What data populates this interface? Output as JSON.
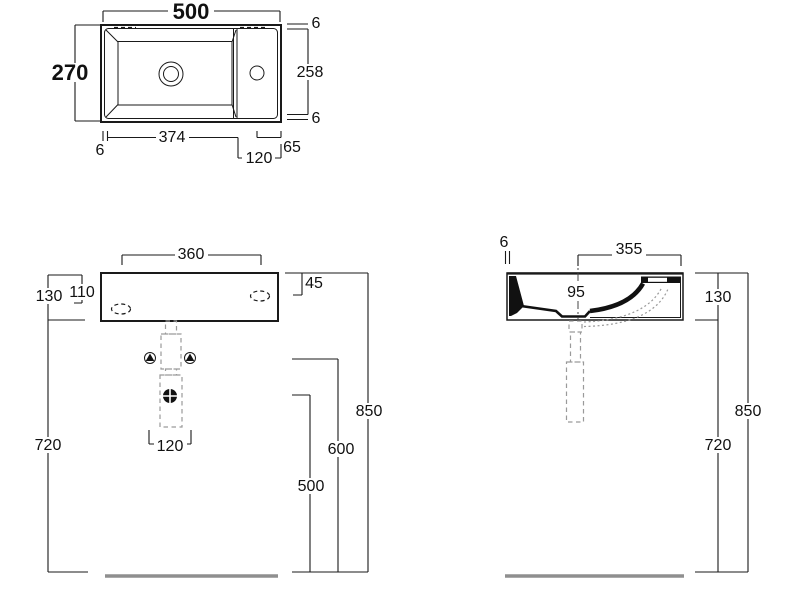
{
  "drawing": {
    "kind": "washbasin technical dimension drawing",
    "views": {
      "plan": {
        "overall_width": "500",
        "overall_depth": "270",
        "edge_top": "6",
        "inner_depth": "258",
        "edge_bottom": "6",
        "edge_left": "6",
        "bowl_length": "374",
        "deck_width": "120",
        "tap_to_edge": "65"
      },
      "front": {
        "fixing_spacing": "360",
        "body_height": "130",
        "fixing_height": "110",
        "fixing_offset": "45",
        "clearance_height": "720",
        "waste_spacing": "120",
        "drain_height": "500",
        "bolt_height": "600",
        "rim_height": "850"
      },
      "section": {
        "wall_thickness": "6",
        "depth": "355",
        "bowl_depth": "95",
        "body_height": "130",
        "rim_height": "850",
        "clearance_height": "720"
      }
    }
  }
}
